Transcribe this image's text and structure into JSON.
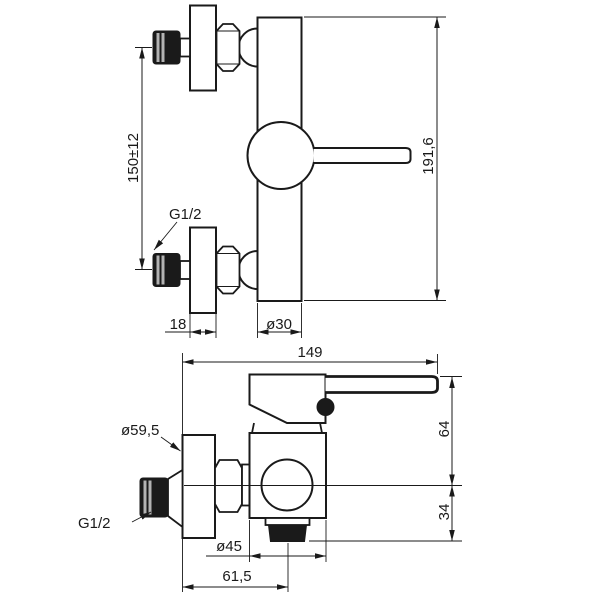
{
  "drawing": {
    "title": "Wall-mounted shower mixer dimensional drawing",
    "colors": {
      "line": "#1a1a1a",
      "background": "#ffffff",
      "thread_stripe": "#b3b3b3"
    },
    "side_view": {
      "inlet_spacing": "150±12",
      "total_height": "191,6",
      "thread": "G1/2",
      "flange_depth": "18",
      "body_diameter": "ø30"
    },
    "front_view": {
      "overall_depth": "149",
      "flange_diameter": "ø59,5",
      "thread": "G1/2",
      "handle_above_center": "64",
      "outlet_below_center": "34",
      "outlet_diameter": "ø45",
      "wall_to_outlet_center": "61,5"
    }
  }
}
